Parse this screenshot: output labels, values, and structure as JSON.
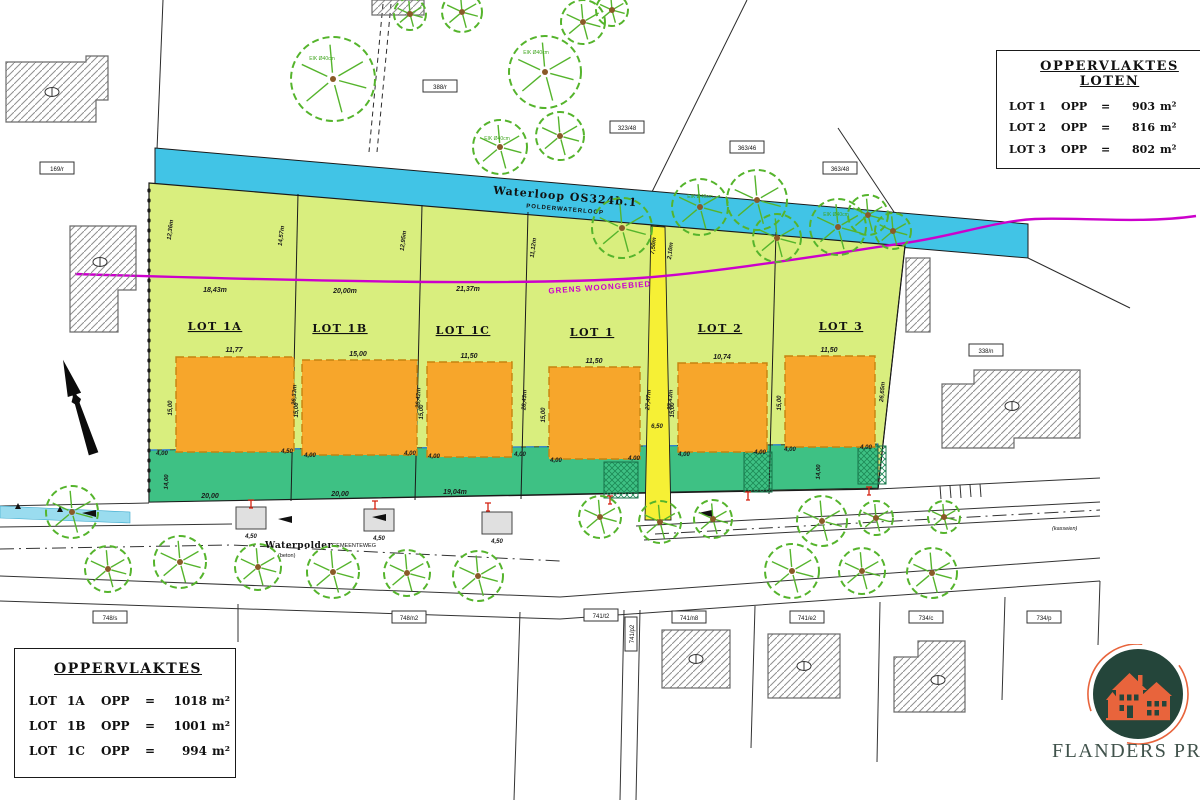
{
  "tables": {
    "loten": {
      "title": "OPPERVLAKTES LOTEN",
      "rows": [
        {
          "lot": "LOT 1",
          "opp": "OPP",
          "eq": "=",
          "value": "903",
          "unit": "m²"
        },
        {
          "lot": "LOT 2",
          "opp": "OPP",
          "eq": "=",
          "value": "816",
          "unit": "m²"
        },
        {
          "lot": "LOT 3",
          "opp": "OPP",
          "eq": "=",
          "value": "802",
          "unit": "m²"
        }
      ]
    },
    "oppervlaktes": {
      "title": "OPPERVLAKTES",
      "rows": [
        {
          "lot": "LOT",
          "num": "1A",
          "opp": "OPP",
          "eq": "=",
          "value": "1018",
          "unit": "m²"
        },
        {
          "lot": "LOT",
          "num": "1B",
          "opp": "OPP",
          "eq": "=",
          "value": "1001",
          "unit": "m²"
        },
        {
          "lot": "LOT",
          "num": "1C",
          "opp": "OPP",
          "eq": "=",
          "value": "994",
          "unit": "m²"
        }
      ]
    }
  },
  "plan": {
    "lots": [
      {
        "label": "LOT 1A"
      },
      {
        "label": "LOT 1B"
      },
      {
        "label": "LOT 1C"
      },
      {
        "label": "LOT 1"
      },
      {
        "label": "LOT 2"
      },
      {
        "label": "LOT 3"
      }
    ],
    "waterway": {
      "name": "Waterloop OS324b.1",
      "type": "POLDERWATERLOOP"
    },
    "boundary_label": "GRENS WOONGEBIED",
    "road": {
      "name": "Waterpolder",
      "type": "GEMEENTEWEG",
      "surface": "(beton)",
      "surface_right": "(kasseien)"
    },
    "tree_label": "EIK Ø40cm",
    "parcels": [
      "169/r",
      "388/r",
      "323/48",
      "363/46",
      "363/48",
      "338/n",
      "748/s",
      "748/n2",
      "741/t2",
      "741/p2",
      "741/n8",
      "741/e2",
      "734/c",
      "734/p"
    ],
    "dims": {
      "frontage": [
        "18,43m",
        "20,00m",
        "21,37m"
      ],
      "rear": [
        "20,00",
        "20,00",
        "19,04m"
      ],
      "widths": [
        "11,77",
        "15,00",
        "11,50",
        "11,50",
        "10,74",
        "11,50"
      ],
      "heights": "15,00",
      "margin": "4,00",
      "margin_alt": "4,50",
      "green_depth": "14,00",
      "drive": "4,50",
      "yellow": {
        "top_left": "7,50m",
        "top_right": "2,10m",
        "left": "27,47m",
        "right": "27,43m",
        "bottom": "6,50"
      },
      "depths": [
        "12,36m",
        "14,57m",
        "12,95m",
        "11,12m",
        "26,33m",
        "26,42m",
        "28,43m",
        "26,65m"
      ]
    }
  },
  "logo": {
    "text": "FLANDERS PROPERTI"
  },
  "colors": {
    "water": "#41c4e6",
    "lot_fill": "#d9ee7e",
    "green_strip": "#3ec184",
    "accent_yellow": "#f6f035",
    "building_orange": "#f7a62b",
    "boundary_magenta": "#cc00cc",
    "tree_green": "#55b42c",
    "logo_green": "#24453a",
    "logo_orange": "#e8643c"
  }
}
